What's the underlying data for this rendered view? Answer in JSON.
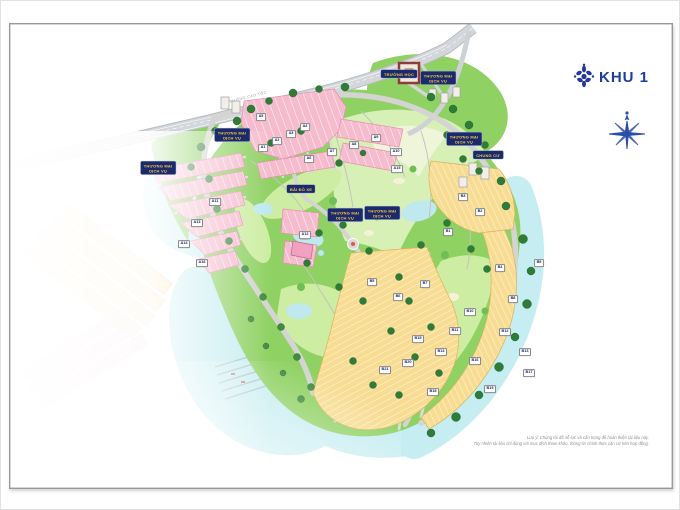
{
  "header": {
    "project_title": "KHU 1",
    "logo_icon": "lotus-icon",
    "compass_icon": "compass-rose-icon",
    "title_color": "#1d3e9a"
  },
  "map": {
    "highway_label": "ĐƯỜNG CAO TỐC",
    "legend_chips": [
      {
        "text": "THƯƠNG MẠI\nDỊCH VỤ",
        "x": 157,
        "y": 167
      },
      {
        "text": "THƯƠNG MẠI\nDỊCH VỤ",
        "x": 231,
        "y": 134
      },
      {
        "text": "TRƯỜNG HỌC",
        "x": 398,
        "y": 73
      },
      {
        "text": "THƯƠNG MẠI\nDỊCH VỤ",
        "x": 437,
        "y": 77
      },
      {
        "text": "BÃI ĐỖ XE",
        "x": 300,
        "y": 188
      },
      {
        "text": "THƯƠNG MẠI\nDỊCH VỤ",
        "x": 344,
        "y": 214
      },
      {
        "text": "THƯƠNG MẠI\nDỊCH VỤ",
        "x": 381,
        "y": 212
      },
      {
        "text": "THƯƠNG MẠI\nDỊCH VỤ",
        "x": 463,
        "y": 138
      },
      {
        "text": "CHUNG CƯ",
        "x": 487,
        "y": 154
      }
    ],
    "block_tags": [
      {
        "id": "A1",
        "x": 262,
        "y": 147
      },
      {
        "id": "A2",
        "x": 276,
        "y": 140
      },
      {
        "id": "A3",
        "x": 290,
        "y": 133
      },
      {
        "id": "A4",
        "x": 304,
        "y": 126
      },
      {
        "id": "A5",
        "x": 260,
        "y": 116
      },
      {
        "id": "A6",
        "x": 308,
        "y": 158
      },
      {
        "id": "A7",
        "x": 331,
        "y": 151
      },
      {
        "id": "A8",
        "x": 353,
        "y": 144
      },
      {
        "id": "A9",
        "x": 375,
        "y": 137
      },
      {
        "id": "A10",
        "x": 395,
        "y": 151
      },
      {
        "id": "A11",
        "x": 214,
        "y": 201
      },
      {
        "id": "A12",
        "x": 304,
        "y": 234
      },
      {
        "id": "A13",
        "x": 196,
        "y": 222
      },
      {
        "id": "A14",
        "x": 183,
        "y": 243
      },
      {
        "id": "A15",
        "x": 396,
        "y": 168
      },
      {
        "id": "A16",
        "x": 201,
        "y": 262
      },
      {
        "id": "B1",
        "x": 447,
        "y": 231
      },
      {
        "id": "B2",
        "x": 479,
        "y": 211
      },
      {
        "id": "B3",
        "x": 462,
        "y": 196
      },
      {
        "id": "B4",
        "x": 499,
        "y": 267
      },
      {
        "id": "B5",
        "x": 371,
        "y": 281
      },
      {
        "id": "B6",
        "x": 397,
        "y": 296
      },
      {
        "id": "B7",
        "x": 424,
        "y": 283
      },
      {
        "id": "B8",
        "x": 512,
        "y": 298
      },
      {
        "id": "B9",
        "x": 538,
        "y": 262
      },
      {
        "id": "B10",
        "x": 469,
        "y": 311
      },
      {
        "id": "B11",
        "x": 454,
        "y": 330
      },
      {
        "id": "B12",
        "x": 504,
        "y": 331
      },
      {
        "id": "B13",
        "x": 524,
        "y": 351
      },
      {
        "id": "B14",
        "x": 440,
        "y": 351
      },
      {
        "id": "B15",
        "x": 417,
        "y": 338
      },
      {
        "id": "B16",
        "x": 474,
        "y": 360
      },
      {
        "id": "B17",
        "x": 528,
        "y": 372
      },
      {
        "id": "B18",
        "x": 432,
        "y": 391
      },
      {
        "id": "B19",
        "x": 489,
        "y": 388
      },
      {
        "id": "B20",
        "x": 407,
        "y": 362
      },
      {
        "id": "B21",
        "x": 384,
        "y": 369
      }
    ],
    "colors": {
      "golf_green": "#8fd163",
      "fairway_light": "#cdeda2",
      "water": "#c6edf1",
      "residential_pink": "#f6bcce",
      "residential_yellow": "#f7dc92",
      "label_chip_bg": "#1b2a6b",
      "label_chip_text": "#f4c844",
      "road_gray": "#d4d4d2"
    }
  },
  "footer": {
    "note_line1": "Lưu ý: Chúng tôi đã nỗ lực và cẩn trọng để hoàn thiện tài liệu này.",
    "note_line2": "Tuy nhiên tài liệu chỉ dùng với mục đích tham khảo, thông tin chính thức căn cứ trên hợp đồng."
  }
}
